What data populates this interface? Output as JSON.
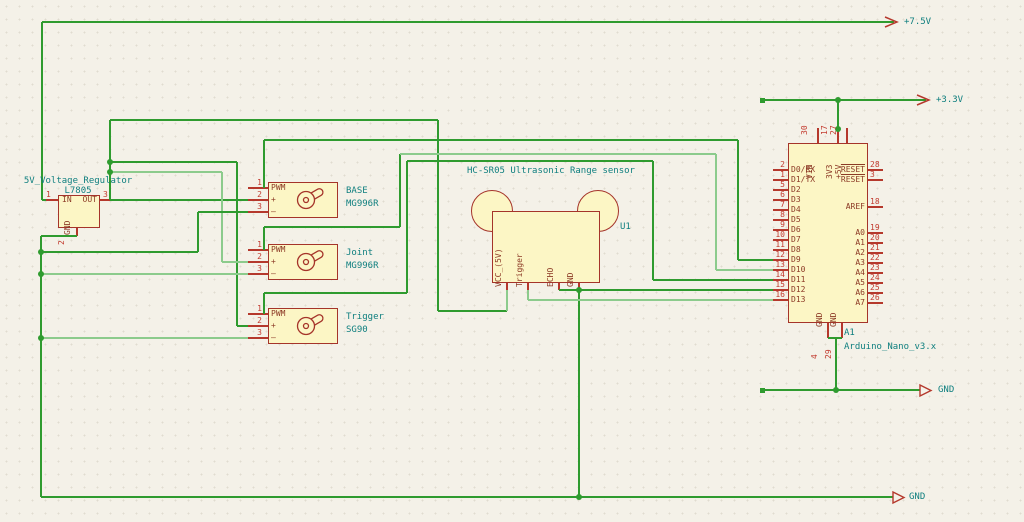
{
  "colors": {
    "background": "#F4F1E8",
    "wire_green": "#2F9B2F",
    "wire_green_light": "#8CCB8C",
    "component_fill": "#FCF6C5",
    "component_border": "#A5342A",
    "pin_red": "#B5382C",
    "pin_number_red": "#C33C30",
    "pin_name_maroon": "#8C3A26",
    "label_teal": "#0F7F7F"
  },
  "power": {
    "v75": "+7.5V",
    "v33": "+3.3V",
    "gnd_right": "GND",
    "gnd_bottom": "GND"
  },
  "regulator": {
    "title": "5V_Voltage_Regulator",
    "value": "L7805",
    "pin_in": {
      "num": "1",
      "label": "IN"
    },
    "pin_out": {
      "num": "3",
      "label": "OUT"
    },
    "pin_gnd": {
      "num": "2",
      "label": "GND"
    }
  },
  "servo_pins": {
    "numbers": [
      "1",
      "2",
      "3"
    ],
    "labels": [
      "PWM",
      "+",
      "–"
    ]
  },
  "servos": [
    {
      "ref": "BASE",
      "model": "MG996R"
    },
    {
      "ref": "Joint",
      "model": "MG996R"
    },
    {
      "ref": "Trigger",
      "model": "SG90"
    }
  ],
  "sensor": {
    "title": "HC-SR05 Ultrasonic Range sensor",
    "ref": "U1",
    "pins": [
      "VCC_(5V)",
      "Trigger",
      "ECHO",
      "GND"
    ]
  },
  "arduino": {
    "ref": "A1",
    "value": "Arduino_Nano_v3.x",
    "top_pins": [
      {
        "num": "30",
        "label": "VIN"
      },
      {
        "num": "17",
        "label": "3V3"
      },
      {
        "num": "27",
        "label": "+5V"
      }
    ],
    "bottom_pins": [
      {
        "num": "4",
        "label": "GND"
      },
      {
        "num": "29",
        "label": "GND"
      }
    ],
    "left_pins": [
      {
        "num": "2",
        "label": "D0/RX"
      },
      {
        "num": "1",
        "label": "D1/TX"
      },
      {
        "num": "5",
        "label": "D2"
      },
      {
        "num": "6",
        "label": "D3"
      },
      {
        "num": "7",
        "label": "D4"
      },
      {
        "num": "8",
        "label": "D5"
      },
      {
        "num": "9",
        "label": "D6"
      },
      {
        "num": "10",
        "label": "D7"
      },
      {
        "num": "11",
        "label": "D8"
      },
      {
        "num": "12",
        "label": "D9"
      },
      {
        "num": "13",
        "label": "D10"
      },
      {
        "num": "14",
        "label": "D11"
      },
      {
        "num": "15",
        "label": "D12"
      },
      {
        "num": "16",
        "label": "D13"
      }
    ],
    "right_pins": [
      {
        "num": "28",
        "label": "RESET",
        "overline": true
      },
      {
        "num": "3",
        "label": "RESET",
        "overline": true
      },
      {
        "num": "18",
        "label": "AREF"
      },
      {
        "num": "19",
        "label": "A0"
      },
      {
        "num": "20",
        "label": "A1"
      },
      {
        "num": "21",
        "label": "A2"
      },
      {
        "num": "22",
        "label": "A3"
      },
      {
        "num": "23",
        "label": "A4"
      },
      {
        "num": "24",
        "label": "A5"
      },
      {
        "num": "25",
        "label": "A6"
      },
      {
        "num": "26",
        "label": "A7"
      }
    ]
  }
}
